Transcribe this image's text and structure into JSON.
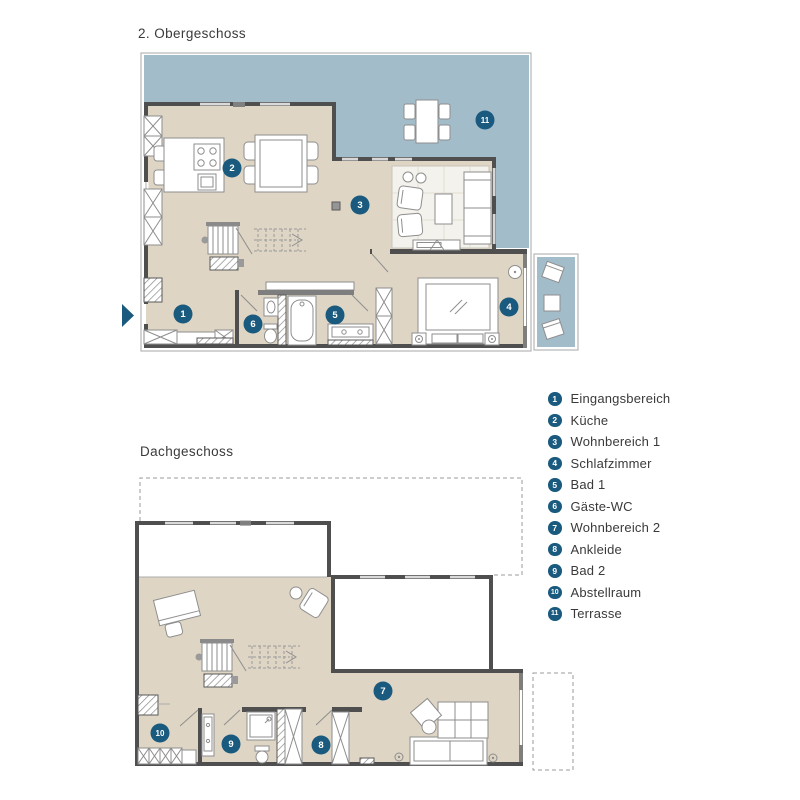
{
  "floors": [
    {
      "id": "obergeschoss",
      "title": "2. Obergeschoss",
      "markers": [
        {
          "num": "1",
          "x": 63,
          "y": 268
        },
        {
          "num": "2",
          "x": 112,
          "y": 122
        },
        {
          "num": "3",
          "x": 240,
          "y": 159
        },
        {
          "num": "4",
          "x": 389,
          "y": 261
        },
        {
          "num": "5",
          "x": 215,
          "y": 269
        },
        {
          "num": "6",
          "x": 133,
          "y": 278
        },
        {
          "num": "11",
          "x": 365,
          "y": 74
        }
      ]
    },
    {
      "id": "dachgeschoss",
      "title": "Dachgeschoss",
      "markers": [
        {
          "num": "7",
          "x": 263,
          "y": 229
        },
        {
          "num": "8",
          "x": 201,
          "y": 283
        },
        {
          "num": "9",
          "x": 111,
          "y": 282
        },
        {
          "num": "10",
          "x": 40,
          "y": 271
        }
      ]
    }
  ],
  "legend": {
    "items": [
      {
        "num": "1",
        "label": "Eingangsbereich"
      },
      {
        "num": "2",
        "label": "Küche"
      },
      {
        "num": "3",
        "label": "Wohnbereich 1"
      },
      {
        "num": "4",
        "label": "Schlafzimmer"
      },
      {
        "num": "5",
        "label": "Bad 1"
      },
      {
        "num": "6",
        "label": "Gäste-WC"
      },
      {
        "num": "7",
        "label": "Wohnbereich 2"
      },
      {
        "num": "8",
        "label": "Ankleide"
      },
      {
        "num": "9",
        "label": "Bad 2"
      },
      {
        "num": "10",
        "label": "Abstellraum"
      },
      {
        "num": "11",
        "label": "Terrasse"
      }
    ]
  },
  "colors": {
    "terrace": "#a3bcc9",
    "floor": "#ded5c4",
    "wall": "#4f4f4f",
    "marker": "#1a5a7e",
    "text": "#3a3a3a"
  }
}
